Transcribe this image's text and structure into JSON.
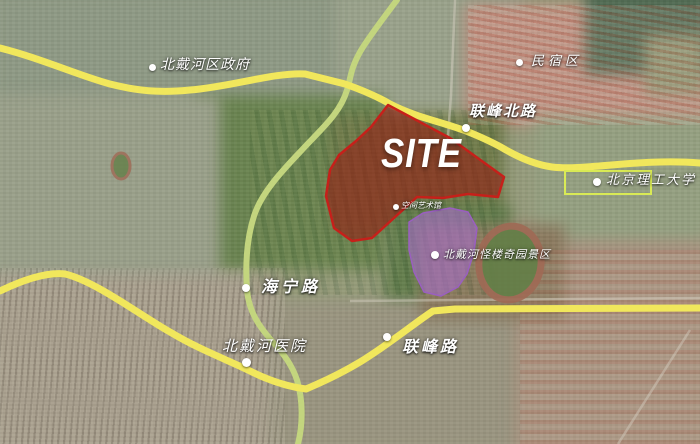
{
  "map": {
    "site_overlay": {
      "label": "SITE"
    },
    "markers": [
      {
        "name": "district-government",
        "text": "北戴河区政府"
      },
      {
        "name": "homestay-area",
        "text": "民宿区"
      },
      {
        "name": "lianfeng-north-road",
        "text": "联峰北路"
      },
      {
        "name": "beijing-institute-of-technology",
        "text": "北京理工大学"
      },
      {
        "name": "art-museum",
        "text": "空间艺术馆"
      },
      {
        "name": "guailou-qiyuan-scenic-area",
        "text": "北戴河怪楼奇园景区"
      },
      {
        "name": "haining-road",
        "text": "海宁路"
      },
      {
        "name": "beidaihe-hospital",
        "text": "北戴河医院"
      },
      {
        "name": "lianfeng-road",
        "text": "联峰路"
      }
    ],
    "colors": {
      "site_fill": "rgba(150,25,18,0.58)",
      "site_border": "#c6201a",
      "scenic_fill": "rgba(167,108,200,0.62)",
      "scenic_border": "#9a5fc0",
      "major_road": "#f1e75c",
      "secondary_road": "#c3d57e",
      "campus_outline": "#d9ea55",
      "label_text": "#ffffff"
    }
  }
}
